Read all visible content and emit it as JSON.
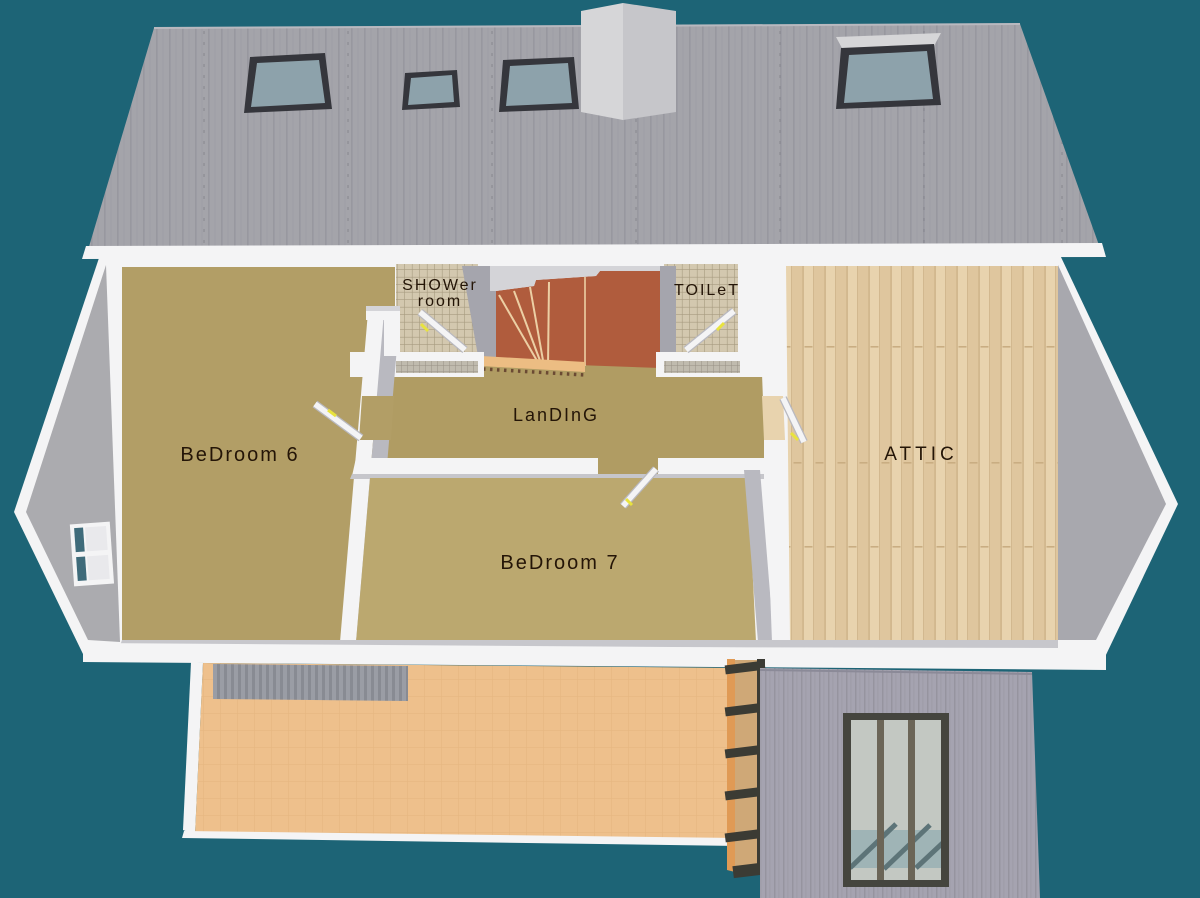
{
  "title": "First floor 3D plan",
  "labels": {
    "shower_line1": "SHOWer",
    "shower_line2": "room",
    "toilet": "TOILeT",
    "landing": "LanDInG",
    "bedroom6": "BeDroom 6",
    "bedroom7": "BeDroom 7",
    "attic": "ATTIC"
  },
  "rooms": [
    {
      "name": "Bedroom 6",
      "floor": "tan carpet"
    },
    {
      "name": "Bedroom 7",
      "floor": "tan carpet"
    },
    {
      "name": "Landing",
      "floor": "tan carpet"
    },
    {
      "name": "Shower room",
      "floor": "beige tile"
    },
    {
      "name": "Toilet",
      "floor": "beige tile"
    },
    {
      "name": "Attic",
      "floor": "light wood plank"
    },
    {
      "name": "Stairs",
      "floor": "terracotta"
    }
  ],
  "colors": {
    "background": "#1d6476",
    "roof": "#a4a4aa",
    "roof_stripe": "#98989f",
    "roof_seam": "#84848c",
    "fascia": "#f4f4f5",
    "wall_face": "#b9b9c0",
    "wall_face_dark": "#a5a5ad",
    "wall_shadow": "#d4d4d8",
    "gable": "#ababaf",
    "gable_right": "#a8a8ae",
    "carpet_bed6": "#b29e66",
    "carpet_bed7": "#bba86f",
    "carpet_landing": "#b09c63",
    "attic_wood": "#e8d3ae",
    "attic_wood2": "#dfc69e",
    "attic_line": "#c9ad82",
    "tile": "#d3c8af",
    "tile_grid": "#a79b80",
    "tile_face": "#c0bbae",
    "tile_face_grid": "#999185",
    "stair": "#b05c3d",
    "stair_line": "#eccfa4",
    "nosing": "#ecbd83",
    "nosing_dark": "#6b4a33",
    "terrace": "#eec08c",
    "terrace_grid": "#dfae77",
    "mat": "#9a9da5",
    "mat_stripe": "#888b93",
    "siding": "#a5a3b0",
    "siding_stripe": "#96949f",
    "glass": "#c3c8c2",
    "glass_teal": "#9fb4b6",
    "glass_line": "#5d7478",
    "frame_dark": "#45453e",
    "mullion": "#6b6557",
    "ladder_wood": "#cfa877",
    "ladder_dark": "#3b3b34",
    "orange": "#e09a55",
    "handle": "#e8e33e",
    "label": "#241507",
    "chimney": "#d6d6d8",
    "chimney_side": "#c6c6ca",
    "skylight_glass": "#8da2ab",
    "skylight_frame": "#35363c",
    "window_teal": "#3f6b7a",
    "window_white": "#e9e9ec"
  }
}
